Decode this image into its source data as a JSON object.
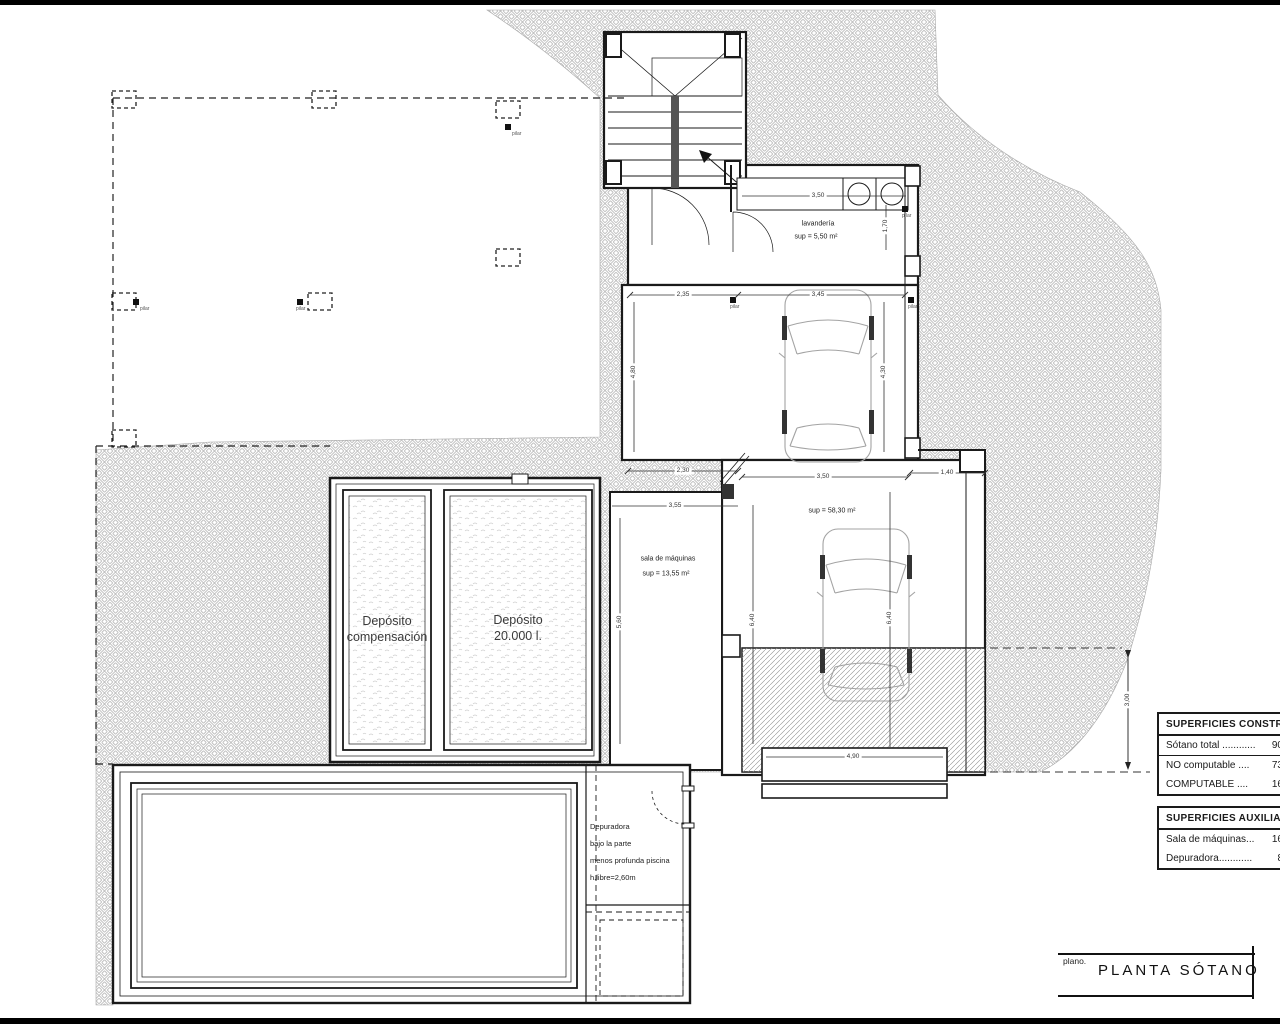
{
  "drawing": {
    "title_block": {
      "field_label": "plano.",
      "title": "PLANTA SÓTANO"
    },
    "rooms": {
      "laundry": {
        "name": "lavandería",
        "area": "sup = 5,50 m²"
      },
      "garage": {
        "area": "sup = 58,30 m²"
      },
      "machine_room": {
        "name": "sala de máquinas",
        "area": "sup = 13,55 m²"
      },
      "tank_compensation": {
        "line1": "Depósito",
        "line2": "compensación"
      },
      "tank_main": {
        "line1": "Depósito",
        "line2": "20.000 l."
      },
      "depuradora_note": {
        "line1": "Depuradora",
        "line2": "bajo la parte",
        "line3": "menos profunda piscina",
        "line4": "h.libre=2,60m"
      }
    },
    "pillar_label": "pilar",
    "dims": {
      "counter_w": "3,50",
      "laundry_side": "1,70",
      "garage_top_left": "2,35",
      "garage_top_right": "3,45",
      "garage_left_h": "4,80",
      "garage_right_h": "4,30",
      "garage_bottom_left": "2,30",
      "garage_bottom_mid": "3,50",
      "garage_bottom_right": "1,40",
      "machine_top": "3,55",
      "machine_left_h": "5,60",
      "garage_low_left_h": "6,40",
      "garage_low_right_h": "6,40",
      "ramp_width": "4,90",
      "ramp_depth": "3,00"
    },
    "tables": {
      "built": {
        "header": "SUPERFICIES CONSTRU",
        "rows": [
          {
            "label": "Sótano total ............",
            "value": "90"
          },
          {
            "label": "NO computable ....",
            "value": "73"
          },
          {
            "label": "COMPUTABLE      ....",
            "value": "16"
          }
        ]
      },
      "aux": {
        "header": "SUPERFICIES AUXILIAR",
        "rows": [
          {
            "label": "Sala de máquinas...",
            "value": "16"
          },
          {
            "label": "Depuradora............",
            "value": "8"
          }
        ]
      }
    },
    "colors": {
      "line": "#1a1a1a",
      "hatch": "#bfbfbf",
      "paper": "#ffffff"
    }
  }
}
